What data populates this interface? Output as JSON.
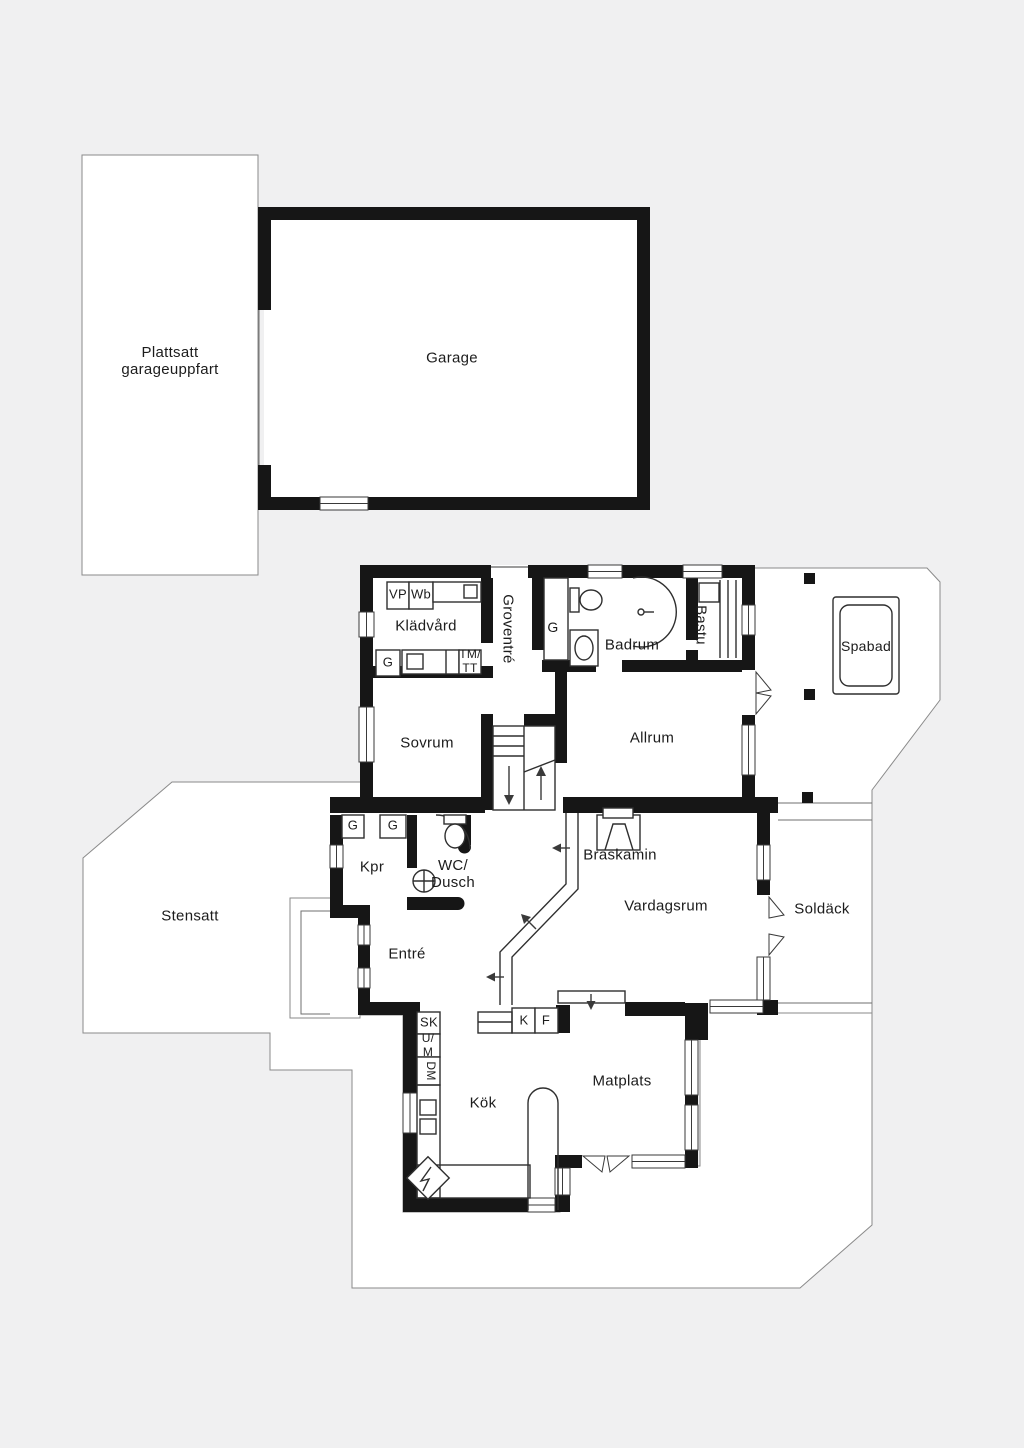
{
  "plan": {
    "type": "floorplan",
    "language": "sv",
    "colors": {
      "background": "#f0f0f1",
      "wall": "#161616",
      "floor": "#ffffff",
      "outline": "#8a8a8a",
      "text": "#1c1c1c"
    },
    "labels": [
      {
        "id": "plattsatt-garageuppfart",
        "text": "Plattsatt\ngarageuppfart",
        "x": 170,
        "y": 361,
        "fs": 15,
        "rot": 0
      },
      {
        "id": "garage",
        "text": "Garage",
        "x": 452,
        "y": 358,
        "fs": 15,
        "rot": 0
      },
      {
        "id": "kladvard",
        "text": "Klädvård",
        "x": 426,
        "y": 626,
        "fs": 15,
        "rot": 0
      },
      {
        "id": "groventre",
        "text": "Groventré",
        "x": 508,
        "y": 629,
        "fs": 15,
        "rot": 90
      },
      {
        "id": "vp",
        "text": "VP",
        "x": 398,
        "y": 595,
        "fs": 13,
        "rot": 0
      },
      {
        "id": "wb",
        "text": "Wb",
        "x": 421,
        "y": 595,
        "fs": 13,
        "rot": 0
      },
      {
        "id": "g-kladvard",
        "text": "G",
        "x": 388,
        "y": 663,
        "fs": 13,
        "rot": 0
      },
      {
        "id": "tm-tt",
        "text": "TM/\nTT",
        "x": 470,
        "y": 662,
        "fs": 12,
        "rot": 0
      },
      {
        "id": "g-groventre",
        "text": "G",
        "x": 553,
        "y": 627,
        "fs": 14,
        "rot": 0
      },
      {
        "id": "badrum",
        "text": "Badrum",
        "x": 632,
        "y": 645,
        "fs": 15,
        "rot": 0
      },
      {
        "id": "bastu",
        "text": "Bastu",
        "x": 701,
        "y": 625,
        "fs": 15,
        "rot": 90
      },
      {
        "id": "spabad",
        "text": "Spabad",
        "x": 866,
        "y": 646,
        "fs": 14,
        "rot": 0
      },
      {
        "id": "sovrum",
        "text": "Sovrum",
        "x": 427,
        "y": 743,
        "fs": 15,
        "rot": 0
      },
      {
        "id": "allrum",
        "text": "Allrum",
        "x": 652,
        "y": 738,
        "fs": 15,
        "rot": 0
      },
      {
        "id": "kpr",
        "text": "Kpr",
        "x": 372,
        "y": 867,
        "fs": 15,
        "rot": 0
      },
      {
        "id": "g-kpr-1",
        "text": "G",
        "x": 353,
        "y": 826,
        "fs": 13,
        "rot": 0
      },
      {
        "id": "g-kpr-2",
        "text": "G",
        "x": 393,
        "y": 826,
        "fs": 13,
        "rot": 0
      },
      {
        "id": "wc-dusch",
        "text": "WC/\nDusch",
        "x": 453,
        "y": 874,
        "fs": 15,
        "rot": 0
      },
      {
        "id": "stensatt",
        "text": "Stensatt",
        "x": 190,
        "y": 916,
        "fs": 15,
        "rot": 0
      },
      {
        "id": "entre",
        "text": "Entré",
        "x": 407,
        "y": 954,
        "fs": 15,
        "rot": 0
      },
      {
        "id": "braskamin",
        "text": "Braskamin",
        "x": 620,
        "y": 855,
        "fs": 15,
        "rot": 0
      },
      {
        "id": "vardagsrum",
        "text": "Vardagsrum",
        "x": 666,
        "y": 906,
        "fs": 15,
        "rot": 0
      },
      {
        "id": "soldack",
        "text": "Soldäck",
        "x": 822,
        "y": 909,
        "fs": 15,
        "rot": 0
      },
      {
        "id": "sk",
        "text": "SK",
        "x": 429,
        "y": 1023,
        "fs": 13,
        "rot": 0
      },
      {
        "id": "u-m",
        "text": "U/\nM",
        "x": 428,
        "y": 1046,
        "fs": 12,
        "rot": 0
      },
      {
        "id": "dm",
        "text": "DM",
        "x": 430,
        "y": 1071,
        "fs": 12,
        "rot": 90
      },
      {
        "id": "k",
        "text": "K",
        "x": 524,
        "y": 1021,
        "fs": 13,
        "rot": 0
      },
      {
        "id": "f",
        "text": "F",
        "x": 546,
        "y": 1021,
        "fs": 13,
        "rot": 0
      },
      {
        "id": "kok",
        "text": "Kök",
        "x": 483,
        "y": 1103,
        "fs": 15,
        "rot": 0
      },
      {
        "id": "matplats",
        "text": "Matplats",
        "x": 622,
        "y": 1081,
        "fs": 15,
        "rot": 0
      }
    ]
  }
}
